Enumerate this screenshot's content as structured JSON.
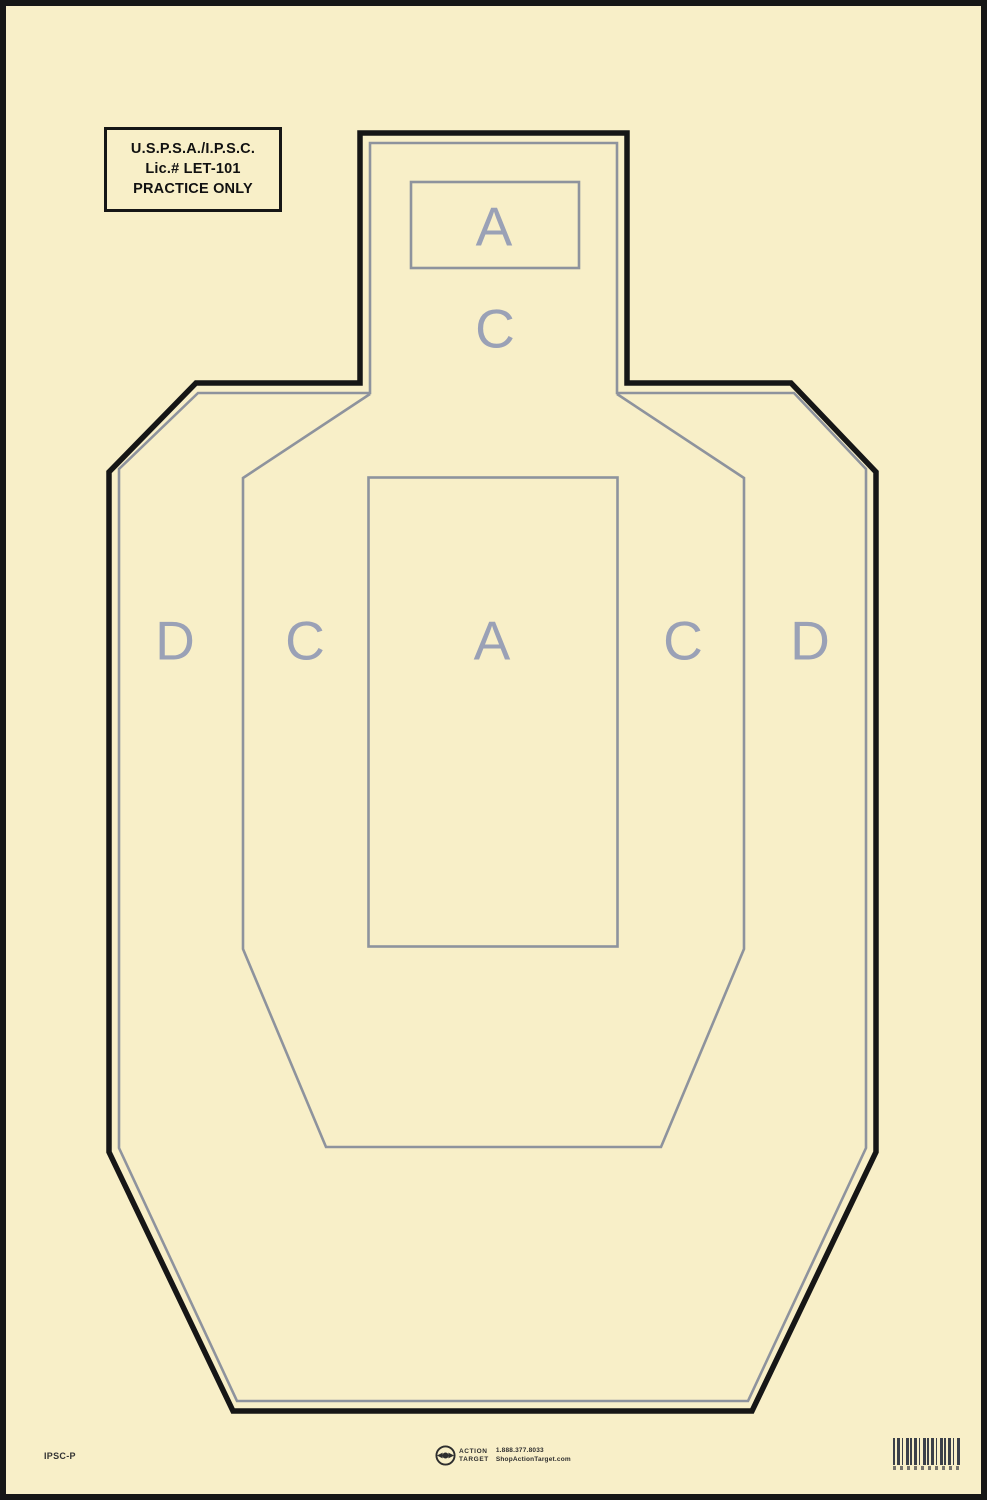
{
  "sheet": {
    "license_box": {
      "line1": "U.S.P.S.A./I.P.S.C.",
      "line2": "Lic.# LET-101",
      "line3": "PRACTICE ONLY"
    },
    "head": {
      "a_label": "A",
      "c_label": "C"
    },
    "body_zones": {
      "d_left": "D",
      "c_left": "C",
      "a_center": "A",
      "c_right": "C",
      "d_right": "D"
    },
    "footer": {
      "model": "IPSC-P",
      "brand_line1": "ACTION",
      "brand_line2": "TARGET",
      "phone": "1.888.377.8033",
      "website": "ShopActionTarget.com"
    }
  },
  "colors": {
    "paper": "#f8efc8",
    "ink_black": "#161616",
    "line_gray": "#8e939d",
    "letter_gray": "#9aa1b6",
    "footer_ink": "#2e2e2e",
    "barcode_ink": "#3b4049"
  }
}
